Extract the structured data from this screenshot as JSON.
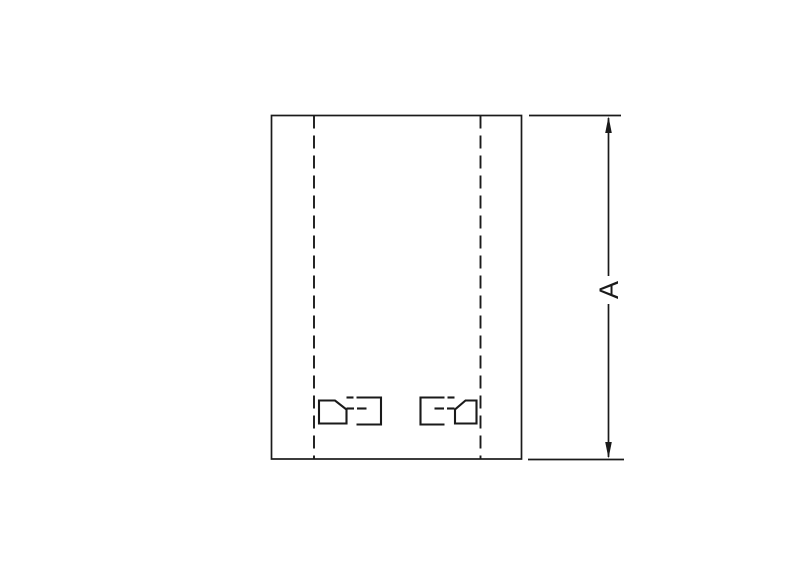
{
  "drawing": {
    "kind": "technical-dimension-drawing",
    "dimension": {
      "label": "A",
      "orientation": "vertical",
      "measures": "overall height of body outline"
    }
  },
  "colors": {
    "line": "#1a1a1a",
    "background": "#ffffff"
  }
}
